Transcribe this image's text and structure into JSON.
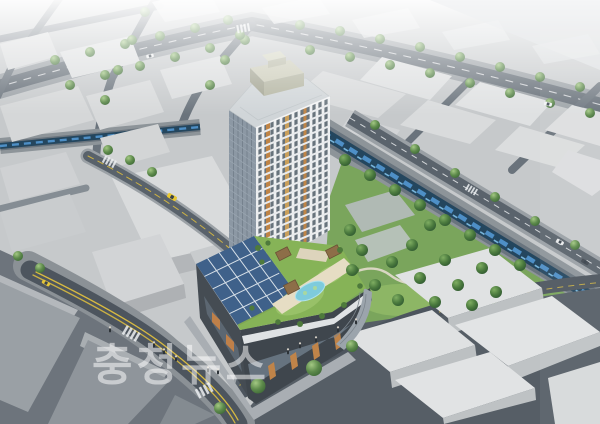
{
  "image": {
    "kind": "architectural-aerial-rendering",
    "subject": "high-rise residential tower with podium roof garden, stream and city blocks"
  },
  "watermark": {
    "text": "충청뉴스"
  },
  "palette": {
    "tower_facade": "#eef0f1",
    "tower_glass": "#8c98a4",
    "tower_accent_orange": "#bf8446",
    "tower_accent_tan": "#caa05c",
    "roof_garden_green": "#86b357",
    "solar_panel_blue": "#3f618a",
    "pool_blue": "#7ecbdc",
    "pergola_brown": "#8d6e48",
    "stream_water": "#24465e",
    "stream_highlight": "#4e8fc6",
    "embankment_gray": "#8d9499",
    "park_green": "#7aa55c",
    "street_asphalt": "#5a636c",
    "foreground_street": "#4d555e",
    "block_massing": "#d9dbdc",
    "road_marking_yellow": "#d8ba40",
    "haze_white": "#f4f6f7"
  }
}
